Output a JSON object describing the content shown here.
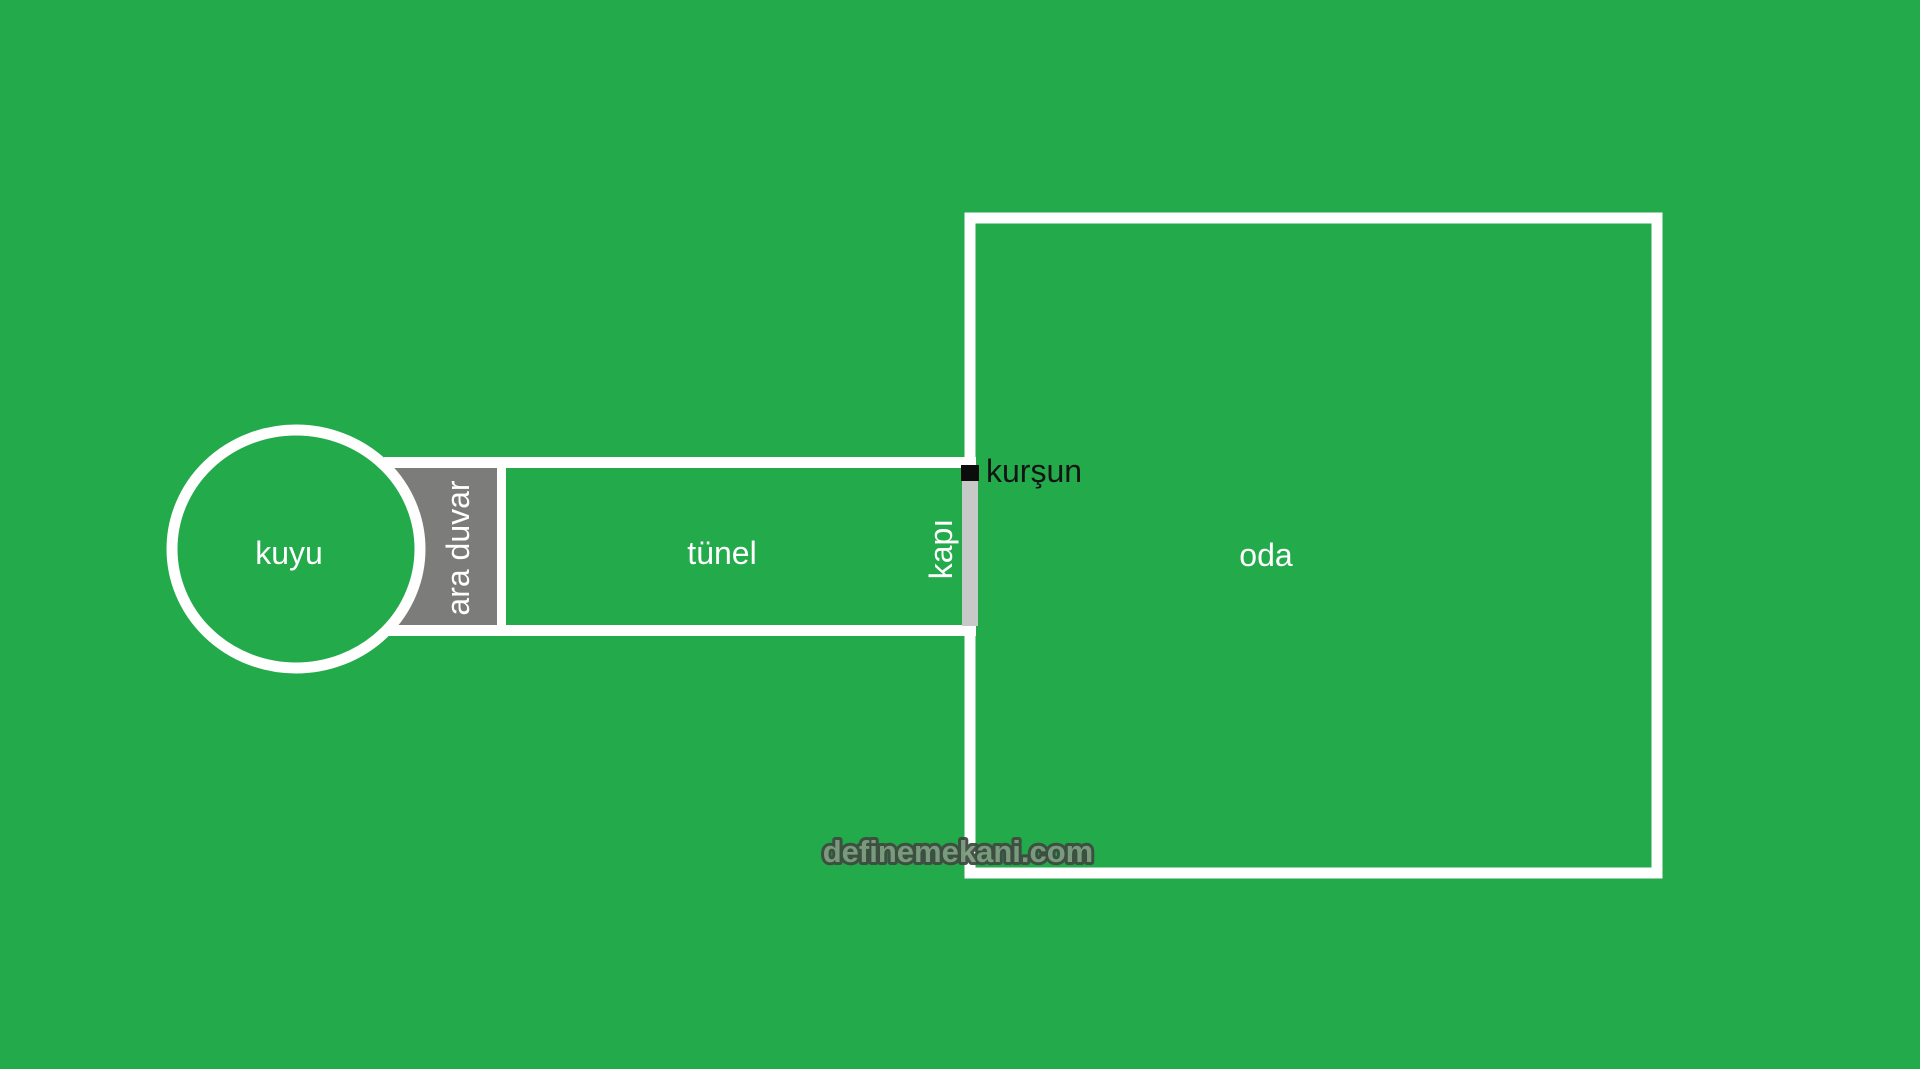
{
  "title": "Treasure map sketch (kuyu - tünel - oda)",
  "colors": {
    "background_green": "#23aa4b",
    "wall_white": "#ffffff",
    "partition_gray": "#7c7c7a",
    "door_gray": "#c6c9c5",
    "lead_black": "#0c0c0c",
    "label_white": "#ffffff",
    "label_black": "#141414",
    "watermark_fill": "#7e9a80",
    "watermark_outline": "#3e4b40"
  },
  "diagram": {
    "labels": {
      "well": "kuyu",
      "partition_wall": "ara duvar",
      "tunnel": "tünel",
      "door": "kapı",
      "lead": "kurşun",
      "room": "oda"
    },
    "watermark": "definemekani.com"
  }
}
